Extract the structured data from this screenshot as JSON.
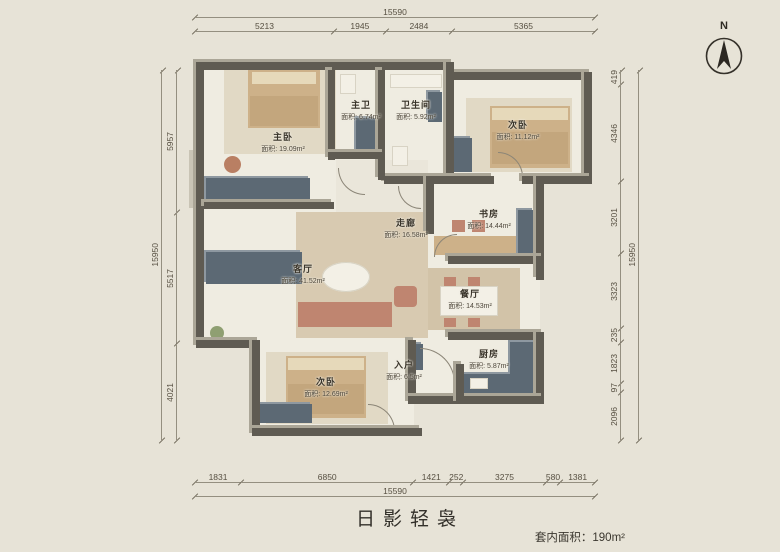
{
  "title": "日影轻袅",
  "area_note": "套内面积：190m²",
  "north_label": "N",
  "dimensions": {
    "top": {
      "overall": "15590",
      "segments": [
        "5213",
        "1945",
        "2484",
        "5365"
      ]
    },
    "bottom": {
      "overall": "15590",
      "segments": [
        "1831",
        "6850",
        "1421",
        "252",
        "3275",
        "580",
        "1381"
      ]
    },
    "left": {
      "overall": "15950",
      "segments": [
        "5957",
        "5517",
        "4021"
      ]
    },
    "right": {
      "overall": "15950",
      "segments": [
        "419",
        "4346",
        "3201",
        "3323",
        "235",
        "1823",
        "97",
        "2096"
      ]
    }
  },
  "rooms": [
    {
      "id": "master-bedroom",
      "name": "主卧",
      "area": "面积: 19.09m²"
    },
    {
      "id": "master-bath",
      "name": "主卫",
      "area": "面积: 6.74m²"
    },
    {
      "id": "bathroom",
      "name": "卫生间",
      "area": "面积: 5.92m²"
    },
    {
      "id": "bedroom-ne",
      "name": "次卧",
      "area": "面积: 11.12m²"
    },
    {
      "id": "study",
      "name": "书房",
      "area": "面积: 14.44m²"
    },
    {
      "id": "corridor",
      "name": "走廊",
      "area": "面积: 16.58m²"
    },
    {
      "id": "living-room",
      "name": "客厅",
      "area": "面积: 41.52m²"
    },
    {
      "id": "dining-room",
      "name": "餐厅",
      "area": "面积: 14.53m²"
    },
    {
      "id": "entry",
      "name": "入户",
      "area": "面积: 6.5m²"
    },
    {
      "id": "kitchen",
      "name": "厨房",
      "area": "面积: 5.87m²"
    },
    {
      "id": "bedroom-sw",
      "name": "次卧",
      "area": "面积: 12.69m²"
    }
  ],
  "colors": {
    "background": "#e7e3d7",
    "floor": "#efece1",
    "wall": "#5f5b52",
    "wall_top": "#aba697",
    "cabinet_navy": "#5c6974",
    "bed_tan": "#cdb189",
    "accent_salmon": "#bf8570",
    "dimension_text": "#564f41"
  }
}
